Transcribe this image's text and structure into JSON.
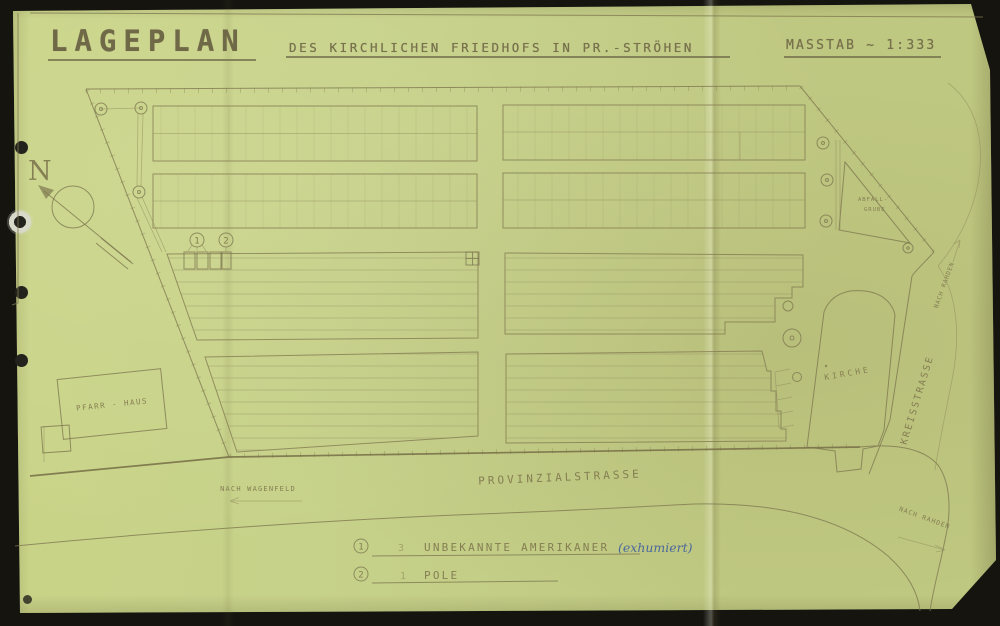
{
  "document": {
    "title": "LAGEPLAN",
    "subtitle": "DES KIRCHLICHEN FRIEDHOFS IN PR.-STRÖHEN",
    "scale": "MASSTAB ~ 1:333"
  },
  "compass": {
    "north": "N"
  },
  "plan": {
    "labels": {
      "pfarrhaus": "PFARR - HAUS",
      "kirche": "KIRCHE",
      "abfall_line1": "ABFALL-",
      "abfall_line2": "GRUBE",
      "provinzialstrasse": "PROVINZIALSTRASSE",
      "kreisstrasse": "KREISSTRASSE",
      "nach_wagenfeld": "NACH WAGENFELD",
      "nach_rahden_south": "NACH RAHDEN",
      "nach_rahden_north": "NACH RAHDEN"
    },
    "markers": {
      "m1": "1",
      "m2": "2"
    }
  },
  "legend": {
    "items": [
      {
        "marker": "1",
        "count": "3",
        "label": "UNBEKANNTE AMERIKANER",
        "note": "(exhumiert)"
      },
      {
        "marker": "2",
        "count": "1",
        "label": "POLE",
        "note": ""
      }
    ]
  },
  "colors": {
    "paper": "#c6d189",
    "ink": "#7b7450",
    "ink_dark": "#6f6948",
    "ink_blue": "#3d5e9e",
    "background": "#15140f"
  }
}
